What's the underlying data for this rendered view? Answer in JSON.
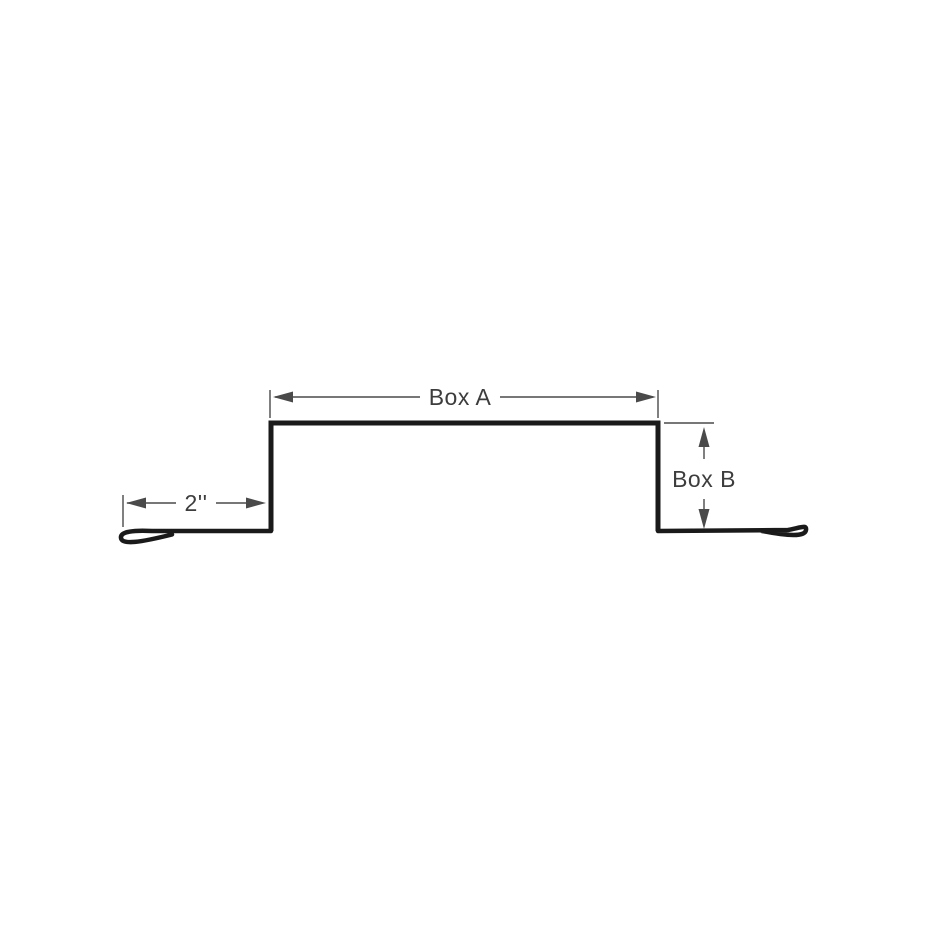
{
  "diagram": {
    "description": "Trim profile cross-section drawing with hemmed edges",
    "labels": {
      "box_a": "Box A",
      "box_b": "Box B",
      "flange_width": "2''"
    },
    "colors": {
      "background": "#ffffff",
      "profile_stroke": "#1a1a1a",
      "dimension_stroke": "#4a4a4a",
      "label_text": "#3d3d3d"
    }
  }
}
